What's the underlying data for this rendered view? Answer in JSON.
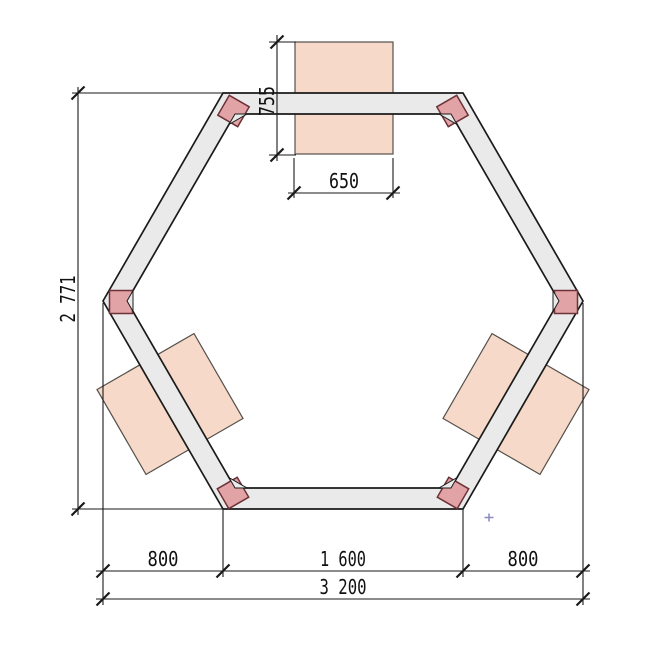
{
  "drawing": {
    "title": "hexagonal-pavilion-plan",
    "dims": {
      "height_total": "2 771",
      "bench_depth": "755",
      "bench_width": "650",
      "bottom_left": "800",
      "bottom_middle": "1 600",
      "bottom_right": "800",
      "bottom_total": "3 200"
    },
    "colors": {
      "frame_fill": "#eaeaea",
      "frame_stroke": "#1b1b1b",
      "post_fill": "#e2a3a6",
      "post_stroke": "#6d3238",
      "bench_fill": "#f6d9c8",
      "bench_stroke": "#55504b",
      "dim_line": "#1a1a1a",
      "cursor": "#8e8ec0"
    },
    "cursor": {
      "glyph": "+"
    }
  }
}
